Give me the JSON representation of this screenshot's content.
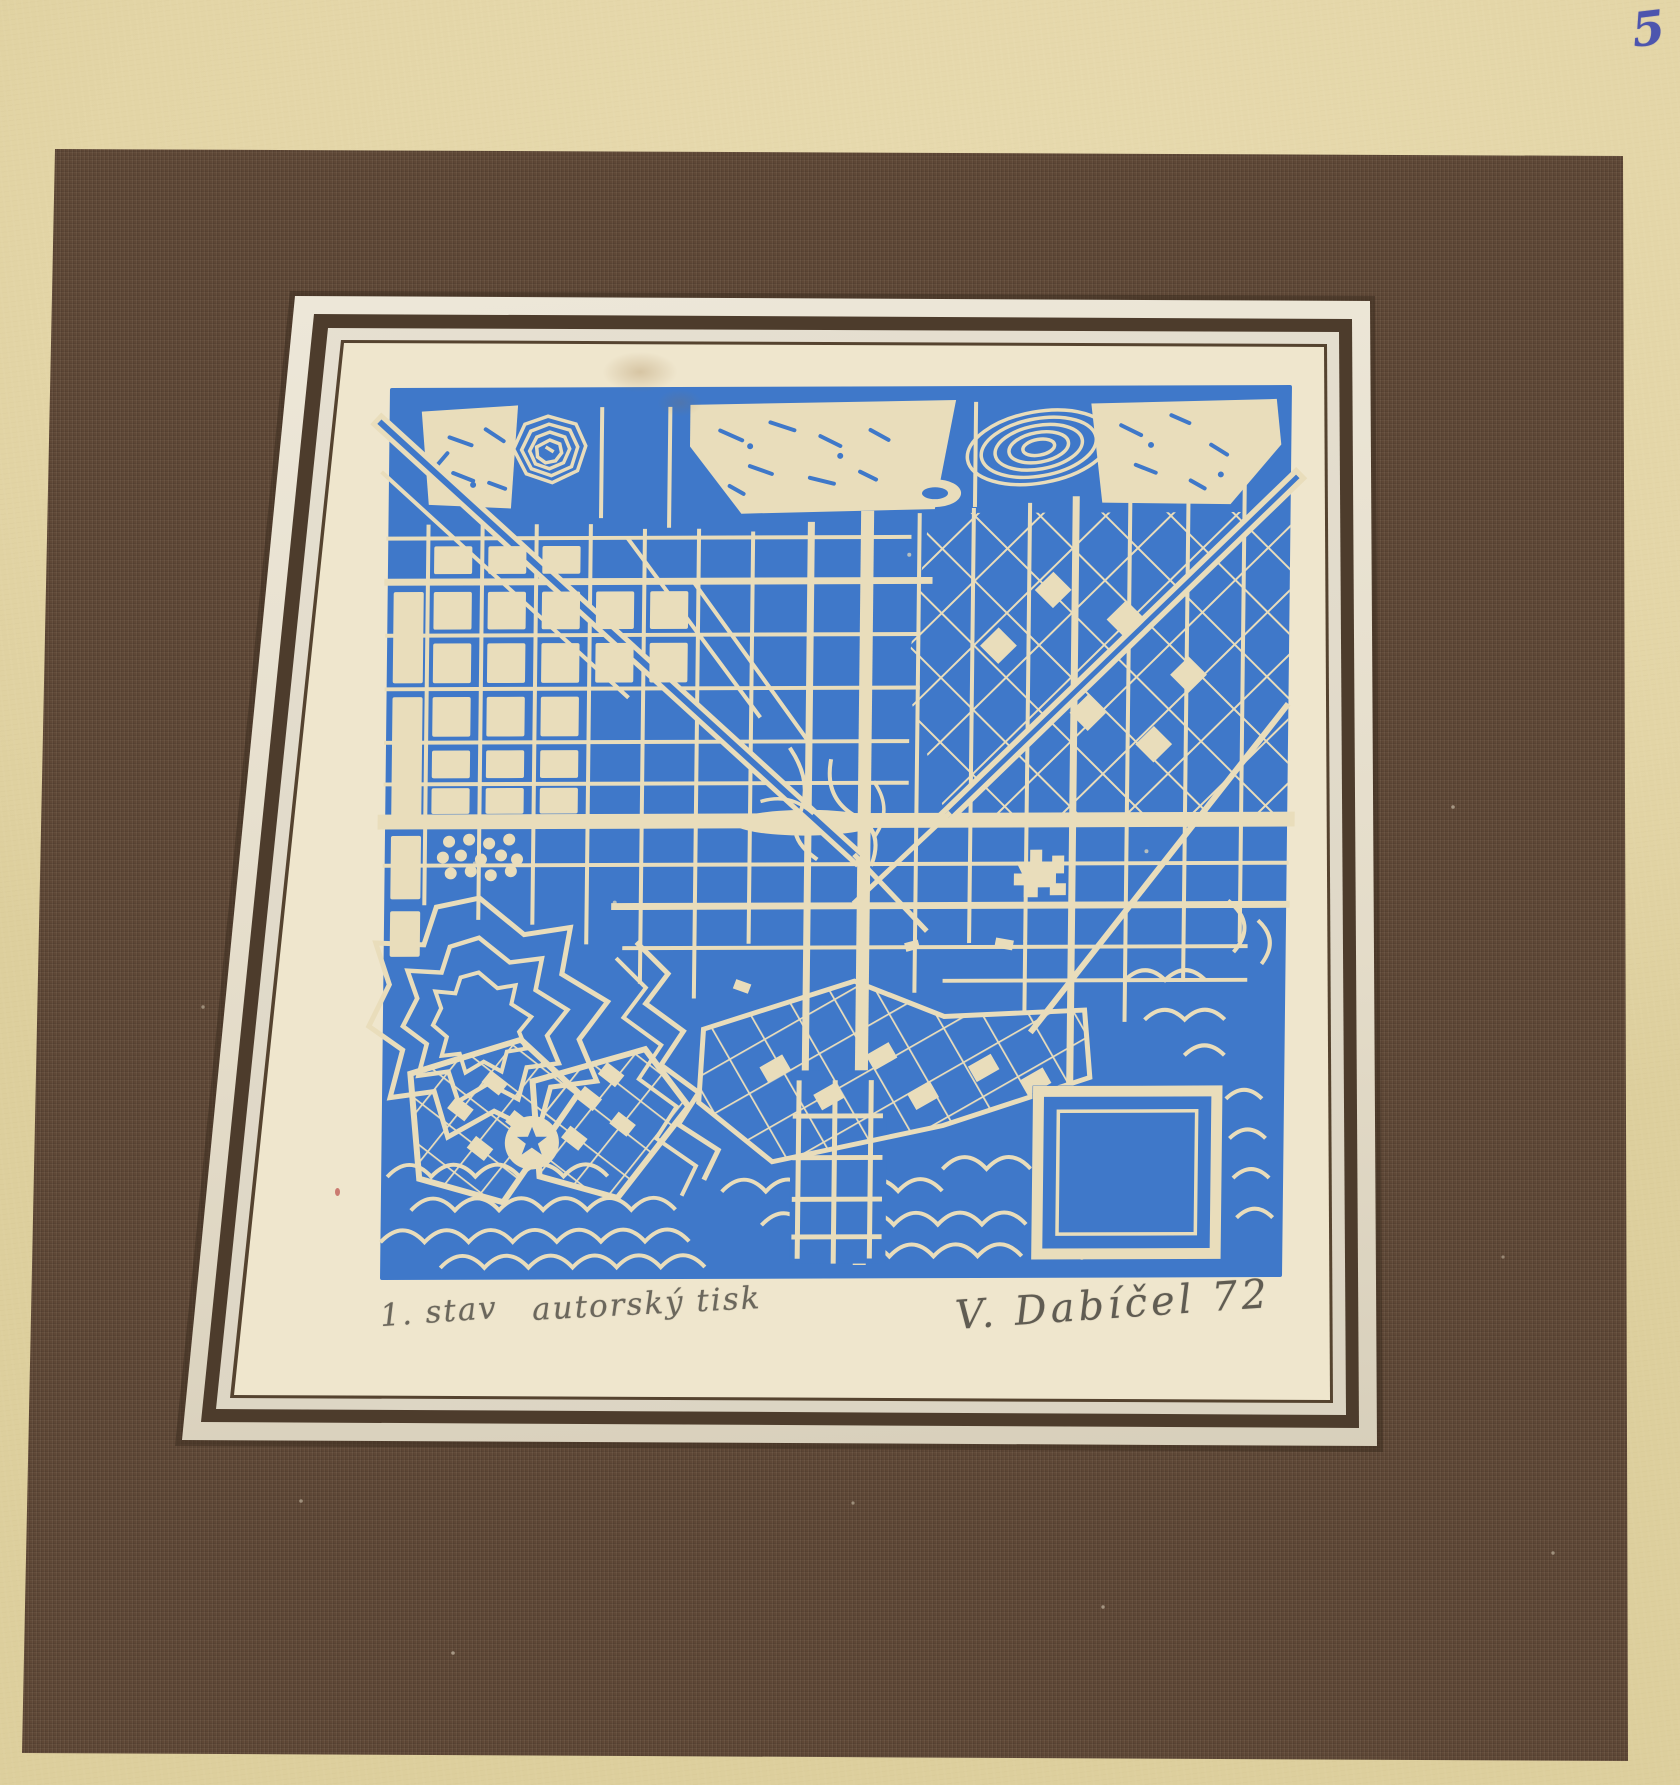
{
  "frame_photo": {
    "corner_number": "5",
    "inscriptions": {
      "state": "1. stav",
      "edition": "autorský tisk",
      "signature": "V. Dabíčel 72"
    }
  },
  "colors": {
    "backing": "#e8dbb0",
    "mat": "#5e4736",
    "frame": "#ece6d8",
    "paper": "#ece2c8",
    "map_blue": "#3f78c9",
    "map_cream": "#e9ddbb",
    "ink": "#4d55ae",
    "pencil": "#6b675c"
  }
}
